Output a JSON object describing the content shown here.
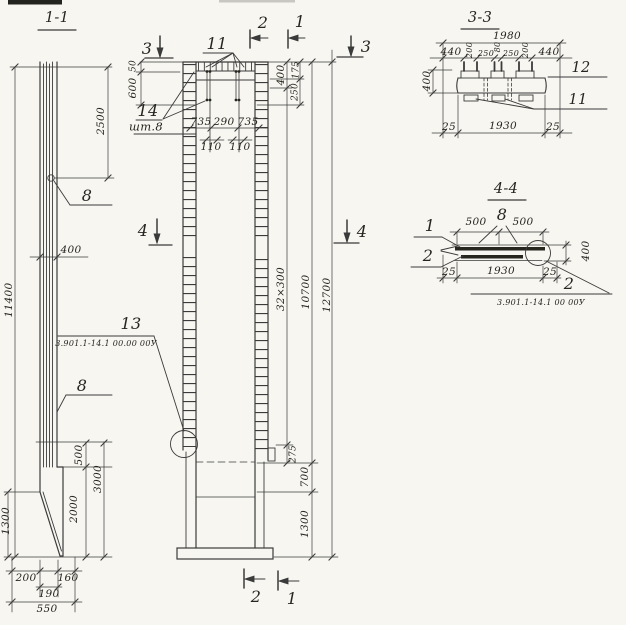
{
  "view_1_1": {
    "title": "1-1",
    "callout_8_upper": "8",
    "callout_8_lower": "8",
    "dims": {
      "overall": "11400",
      "top": "2500",
      "width": "400",
      "tie": "500",
      "shoe": "3000",
      "wedge": "2000",
      "side": "1300",
      "b200": "200",
      "b160": "160",
      "b190": "190",
      "b550": "550"
    }
  },
  "view_plan": {
    "marks": {
      "top_3_left": "3",
      "top_2": "2",
      "top_1": "1",
      "top_3_right": "3",
      "mid_4_left": "4",
      "mid_4_right": "4",
      "bottom_2": "2",
      "bottom_1": "1"
    },
    "callout_11": "11",
    "callout_14": "14",
    "callout_14_qty": "шт.8",
    "callout_13": "13",
    "doc_ref": "3.901.1-14.1 00.00 00У",
    "dims": {
      "d50": "50",
      "d600": "600",
      "d735_left": "735",
      "d290": "290",
      "d735_right": "735",
      "d110_left": "110",
      "d110_right": "110",
      "d400": "400",
      "d175": "175",
      "d250": "250",
      "spacing": "32×300",
      "len_10700": "10700",
      "len_12700": "12700",
      "d275": "275",
      "d700": "700",
      "d1300": "1300"
    }
  },
  "section_3_3": {
    "title": "3-3",
    "callout_12": "12",
    "callout_11": "11",
    "dims": {
      "w1980": "1980",
      "left_440": "440",
      "s200_a": "200",
      "s250_a": "250",
      "s80": "80",
      "s250_b": "250",
      "s200_b": "200",
      "right_440": "440",
      "h400": "400",
      "b25_left": "25",
      "b1930": "1930",
      "b25_right": "25"
    }
  },
  "section_4_4": {
    "title": "4-4",
    "callout_1": "1",
    "callout_2": "2",
    "callout_8": "8",
    "callout_2_detail": "2",
    "doc_ref": "3.901.1-14.1 00 00У",
    "dims": {
      "s500_left": "500",
      "s500_right": "500",
      "h400": "400",
      "b25_left": "25",
      "b1930": "1930",
      "b25_right": "25"
    }
  },
  "colors": {
    "ink": "#3b3b3b",
    "paper": "#f7f6f1"
  }
}
